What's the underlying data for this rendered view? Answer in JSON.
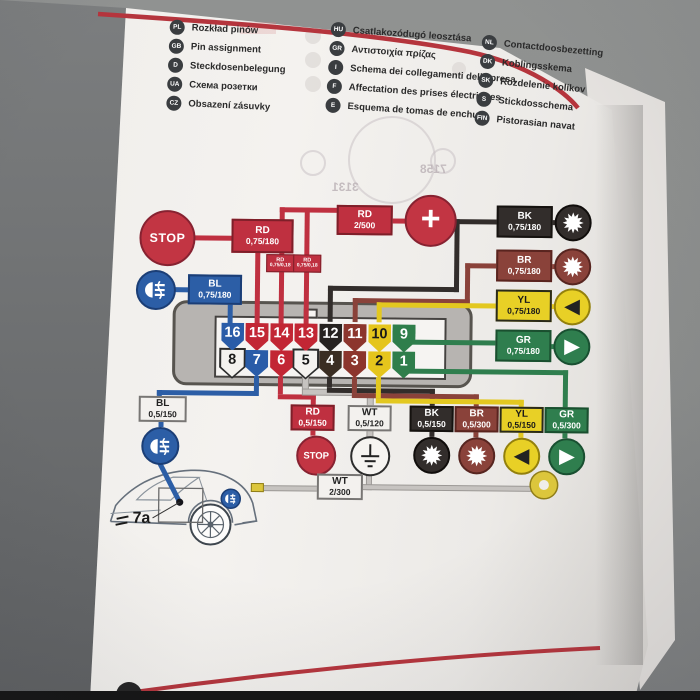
{
  "legend": {
    "columns": [
      {
        "items": [
          {
            "code": "PL",
            "label": "Rozkład pinów"
          },
          {
            "code": "GB",
            "label": "Pin assignment"
          },
          {
            "code": "D",
            "label": "Steckdosenbelegung"
          },
          {
            "code": "UA",
            "label": "Схема розетки"
          },
          {
            "code": "CZ",
            "label": "Obsazení zásuvky"
          }
        ]
      },
      {
        "items": [
          {
            "code": "HU",
            "label": "Csatlakozódugó leosztása"
          },
          {
            "code": "GR",
            "label": "Αντιστοιχία πρίζας"
          },
          {
            "code": "I",
            "label": "Schema dei collegamenti della presa"
          },
          {
            "code": "F",
            "label": "Affectation des prises électriques"
          },
          {
            "code": "E",
            "label": "Esquema de tomas de enchufe"
          }
        ]
      },
      {
        "items": [
          {
            "code": "NL",
            "label": "Contactdoosbezetting"
          },
          {
            "code": "DK",
            "label": "Koblingsskema"
          },
          {
            "code": "SK",
            "label": "Rozdelenie kolíkov"
          },
          {
            "code": "S",
            "label": "Stickdosschema"
          },
          {
            "code": "FIN",
            "label": "Pistorasian navat"
          }
        ]
      }
    ]
  },
  "pins": {
    "top": [
      "16",
      "15",
      "14",
      "13",
      "12",
      "11",
      "10",
      "9"
    ],
    "bottom": [
      "8",
      "7",
      "6",
      "5",
      "4",
      "3",
      "2",
      "1"
    ]
  },
  "wires": {
    "stop_top": {
      "code": "RD",
      "spec": "0,75/180"
    },
    "battery": {
      "code": "RD",
      "spec": "2/500"
    },
    "jumper_a": {
      "code": "RD",
      "spec": "0,75/0,18"
    },
    "jumper_b": {
      "code": "RD",
      "spec": "0,75/0,18"
    },
    "fog_top": {
      "code": "BL",
      "spec": "0,75/180"
    },
    "black_top": {
      "code": "BK",
      "spec": "0,75/180"
    },
    "brown_top": {
      "code": "BR",
      "spec": "0,75/180"
    },
    "yellow_top": {
      "code": "YL",
      "spec": "0,75/180"
    },
    "green_top": {
      "code": "GR",
      "spec": "0,75/180"
    },
    "fog_bottom": {
      "code": "BL",
      "spec": "0,5/150"
    },
    "stop_bottom": {
      "code": "RD",
      "spec": "0,5/150"
    },
    "white_bottom": {
      "code": "WT",
      "spec": "0,5/120"
    },
    "black_bottom": {
      "code": "BK",
      "spec": "0,5/150"
    },
    "brown_bottom": {
      "code": "BR",
      "spec": "0,5/300"
    },
    "yellow_bottom": {
      "code": "YL",
      "spec": "0,5/150"
    },
    "green_bottom": {
      "code": "GR",
      "spec": "0,5/300"
    },
    "ground_main": {
      "code": "WT",
      "spec": "2/300"
    }
  },
  "symbols": {
    "stop_top": "STOP",
    "stop_bottom": "STOP",
    "battery_plus": "+",
    "arrow_left": "◀",
    "arrow_right": "▶",
    "car_ref": "7a"
  },
  "ghost_bleedthrough": {
    "num_a": "7158",
    "num_b": "3131"
  },
  "icons": {
    "lamp_starburst": "12-point-star",
    "rear_fog_lamp": "fog-lamp-glyph",
    "earth_ground": "ground-symbol",
    "ring_terminal": "yellow-ring-lug",
    "left_arrow": "◀",
    "right_arrow": "▶",
    "plus": "+"
  },
  "colors": {
    "accent_red": "#b5353d",
    "wire_red": "#bf3040",
    "wire_blue": "#2c5ea6",
    "wire_black": "#322d2b",
    "wire_brown": "#8a423a",
    "wire_yellow": "#e3c820",
    "wire_green": "#2f7e4e",
    "wire_white": "#c6c3c0"
  }
}
